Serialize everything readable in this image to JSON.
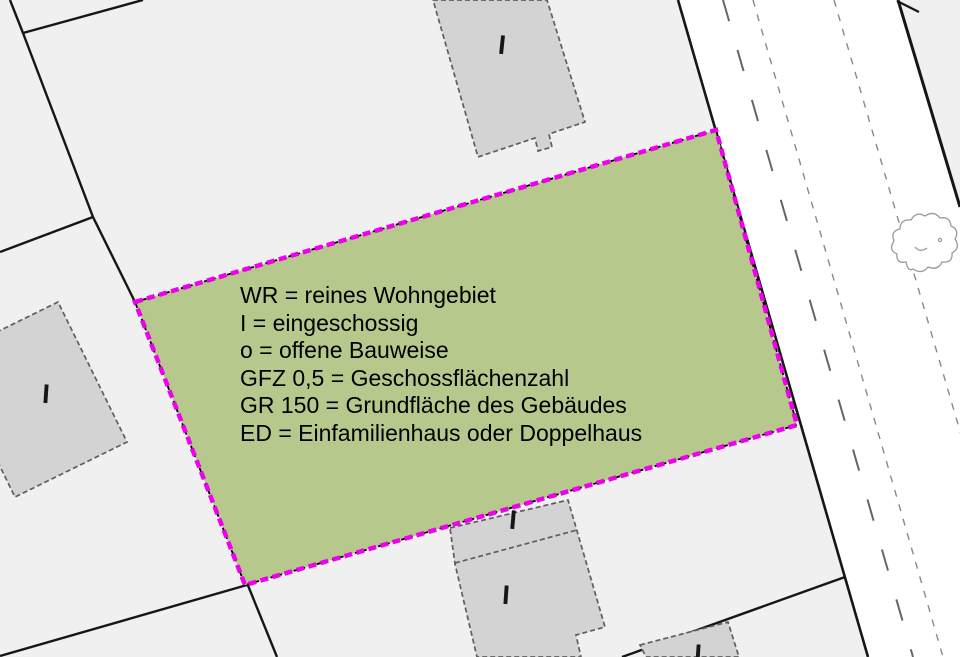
{
  "map": {
    "type": "zoning-plan-excerpt",
    "legend": {
      "lines": [
        "WR = reines Wohngebiet",
        "I = eingeschossig",
        "o = offene Bauweise",
        "GFZ 0,5 = Geschossflächenzahl",
        "GR 150 = Grundfläche des Gebäudes",
        "ED = Einfamilienhaus oder Doppelhaus"
      ]
    },
    "buildings": [
      {
        "label": "I"
      },
      {
        "label": "I"
      },
      {
        "label": "I"
      },
      {
        "label": "I"
      },
      {
        "label": "I"
      }
    ],
    "colors": {
      "background": "#f0f0f0",
      "road_fill": "#ffffff",
      "parcel_fill": "#b7c88c",
      "boundary_magenta": "#ee00ee",
      "building_fill": "#d3d3d3",
      "building_outline": "#5e5e5e",
      "line_black": "#161616",
      "road_marking_gray": "#666666"
    }
  }
}
